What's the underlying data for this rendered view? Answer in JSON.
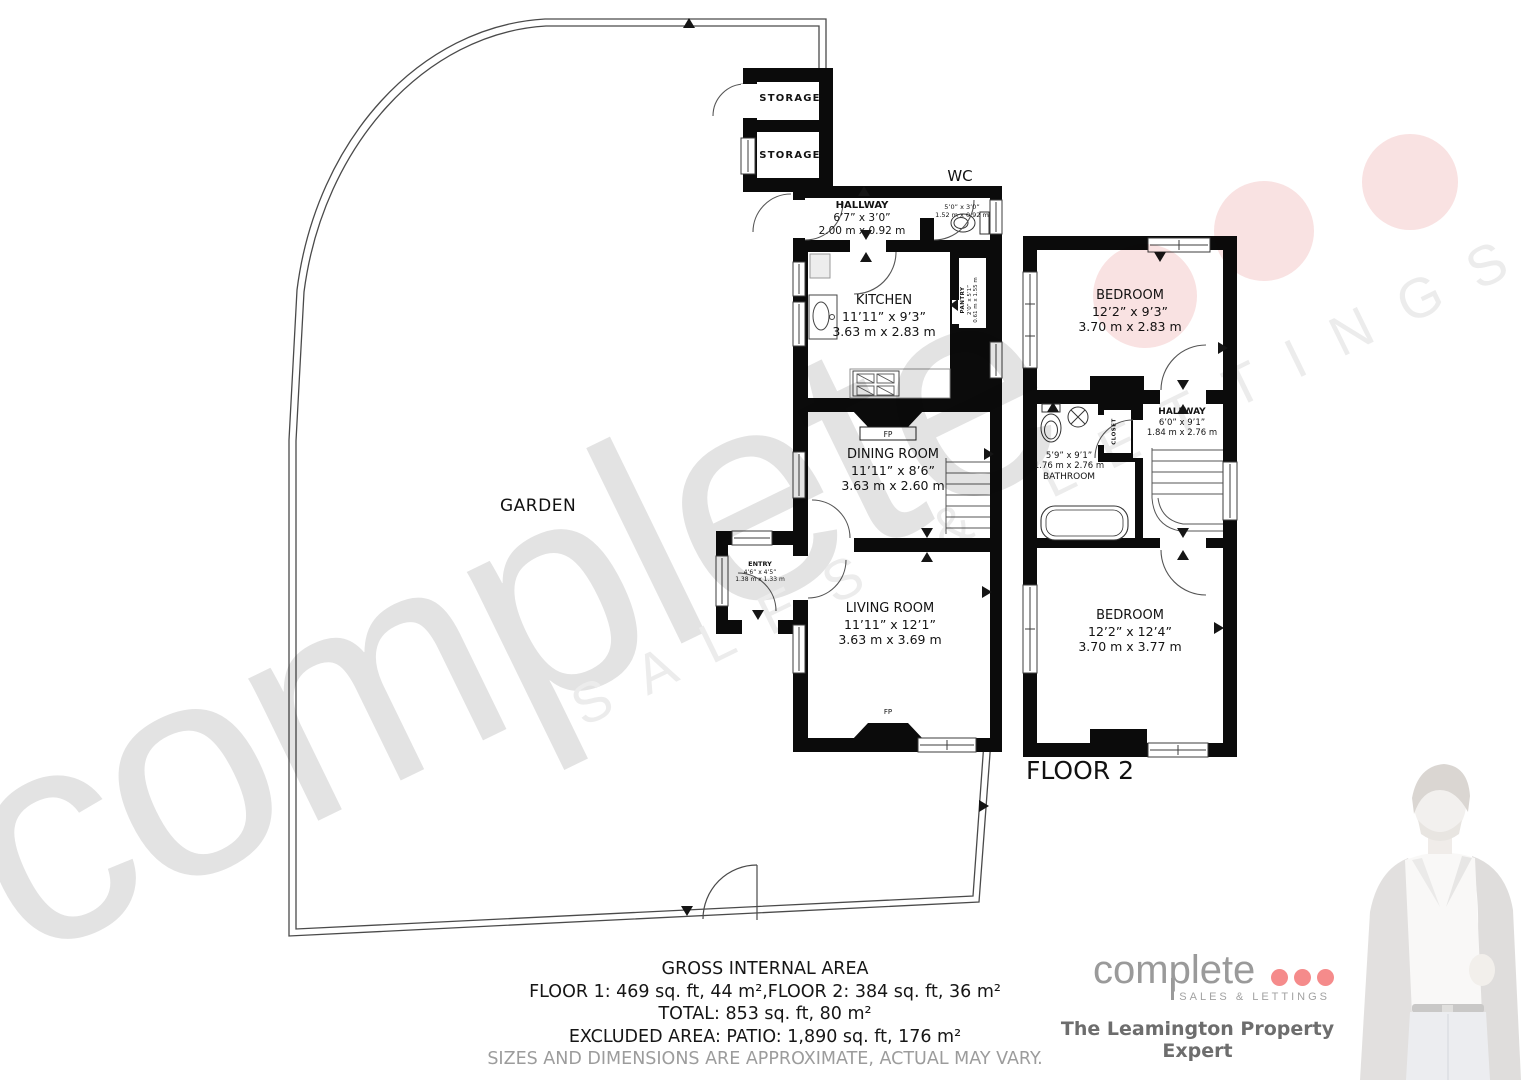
{
  "garden": {
    "label": "GARDEN"
  },
  "floor1": {
    "storage_top": "STORAGE",
    "storage_bottom": "STORAGE",
    "wc_title": "WC",
    "hallway": {
      "name": "HALLWAY",
      "imperial": "6’7” x 3’0”",
      "metric": "2.00 m x 0.92 m"
    },
    "wc": {
      "imperial": "5’0” x 3’0”",
      "metric": "1.52 m x 0.92 m"
    },
    "kitchen": {
      "name": "KITCHEN",
      "imperial": "11’11” x 9’3”",
      "metric": "3.63 m x 2.83 m"
    },
    "pantry": {
      "name": "PANTRY",
      "imperial": "2’0” x 5’1”",
      "metric": "0.61 m x 1.55 m"
    },
    "dining_room": {
      "name": "DINING ROOM",
      "imperial": "11’11” x 8’6”",
      "metric": "3.63 m x 2.60 m"
    },
    "entry": {
      "name": "ENTRY",
      "imperial": "4’6” x 4’5”",
      "metric": "1.38 m x 1.33 m"
    },
    "living_room": {
      "name": "LIVING ROOM",
      "imperial": "11’11” x 12’1”",
      "metric": "3.63 m x 3.69 m"
    },
    "fireplace": "FP"
  },
  "floor2": {
    "title": "FLOOR 2",
    "bedroom_top": {
      "name": "BEDROOM",
      "imperial": "12’2” x 9’3”",
      "metric": "3.70 m x 2.83 m"
    },
    "hallway": {
      "name": "HALLWAY",
      "imperial": "6’0” x 9’1”",
      "metric": "1.84 m x 2.76 m"
    },
    "bathroom": {
      "name": "BATHROOM",
      "imperial": "5’9” x 9’1”",
      "metric": "1.76 m x 2.76 m"
    },
    "closet": "CLOSET",
    "bedroom_bottom": {
      "name": "BEDROOM",
      "imperial": "12’2” x 12’4”",
      "metric": "3.70 m x 3.77 m"
    }
  },
  "summary": {
    "title": "GROSS INTERNAL AREA",
    "line_floors": "FLOOR 1: 469 sq. ft, 44 m²,FLOOR 2: 384 sq. ft, 36 m²",
    "line_total": "TOTAL: 853 sq. ft, 80 m²",
    "line_excluded": "EXCLUDED AREA: PATIO: 1,890 sq. ft, 176 m²",
    "disclaimer": "SIZES AND DIMENSIONS ARE APPROXIMATE, ACTUAL MAY VARY."
  },
  "branding": {
    "logo_word": "complete",
    "logo_sub": "SALES & LETTINGS",
    "tagline": "The Leamington Property Expert"
  },
  "watermark": {
    "word": "complete",
    "sub": "SALES & LETTINGS"
  },
  "colors": {
    "wall": "#0b0b0b",
    "accent_pink": "#f58b8b",
    "watermark_gray": "#e3e3e3",
    "watermark_pink": "#f9e2e2",
    "logo_gray": "#9a9a9a",
    "tagline_gray": "#6d6d6d",
    "disclaimer_gray": "#9c9c9c"
  }
}
